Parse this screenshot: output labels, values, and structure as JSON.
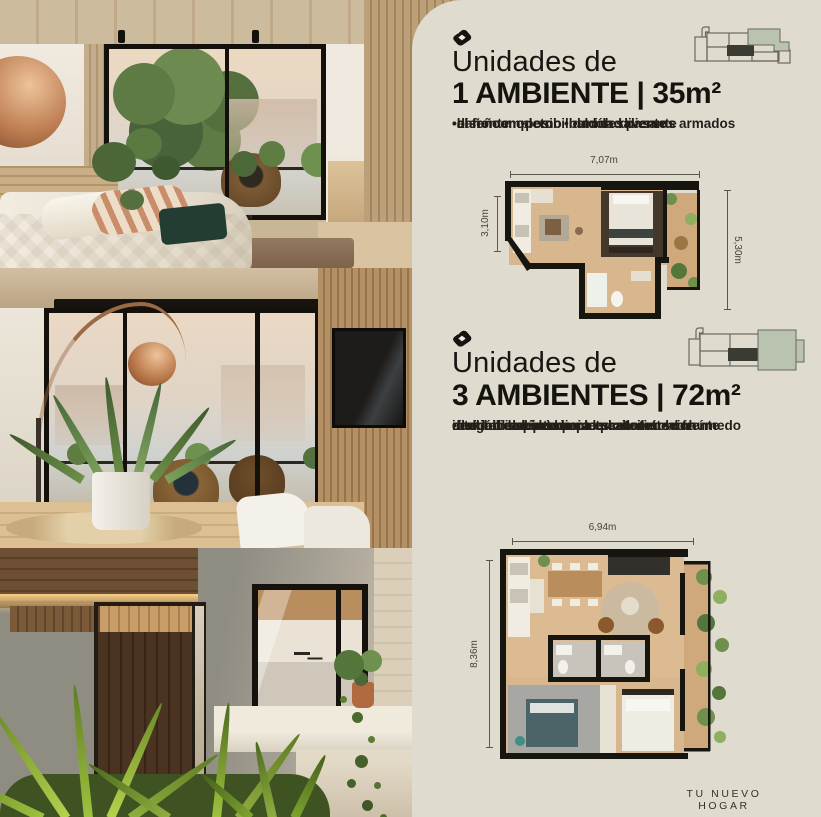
{
  "page": {
    "background": "#dfdbcf",
    "footer": "TU NUEVO HOGAR"
  },
  "colors": {
    "accent_sage": "#b9c3af",
    "accent_dark": "#3a3b33",
    "text": "#1c1a15",
    "wall_black": "#17150f"
  },
  "sections": [
    {
      "icon": "gem-icon",
      "icon_count": 1,
      "title_line1": "Unidades de",
      "title_line2": "1 AMBIENTE | 35m²",
      "feature_lines": [
        "•diseño moderno   •unidad pasante",
        "•al frente   •posibilidad de diversos armados",
        "•baño completo   •balcón saliente"
      ],
      "features": [
        "diseño moderno",
        "unidad pasante",
        "al frente",
        "posibilidad de diversos armados",
        "baño completo",
        "balcón saliente"
      ],
      "plan": {
        "top_dim": "7,07m",
        "left_dim": "3,10m",
        "right_dim": "5,30m"
      }
    },
    {
      "icon": "gem-icon",
      "icon_count": 3,
      "title_line1": "Unidades de",
      "title_line2": "3 AMBIENTES | 72m²",
      "feature_lines": [
        "•unidad independiente pasante   •al frente",
        "•balcón corrido hacia la calle   •cocina",
        "integrada al estar-comedor   •núcleo húmedo",
        "central   •baño completo   •toilette con",
        "ducha   •espacio para escritorio",
        "•flexibilidad interior"
      ],
      "features": [
        "unidad independiente pasante",
        "al frente",
        "balcón corrido hacia la calle",
        "cocina integrada al estar-comedor",
        "núcleo húmedo central",
        "baño completo",
        "toilette con ducha",
        "espacio para escritorio",
        "flexibilidad interior"
      ],
      "plan": {
        "top_dim": "6,94m",
        "left_dim": "8,36m"
      }
    }
  ]
}
